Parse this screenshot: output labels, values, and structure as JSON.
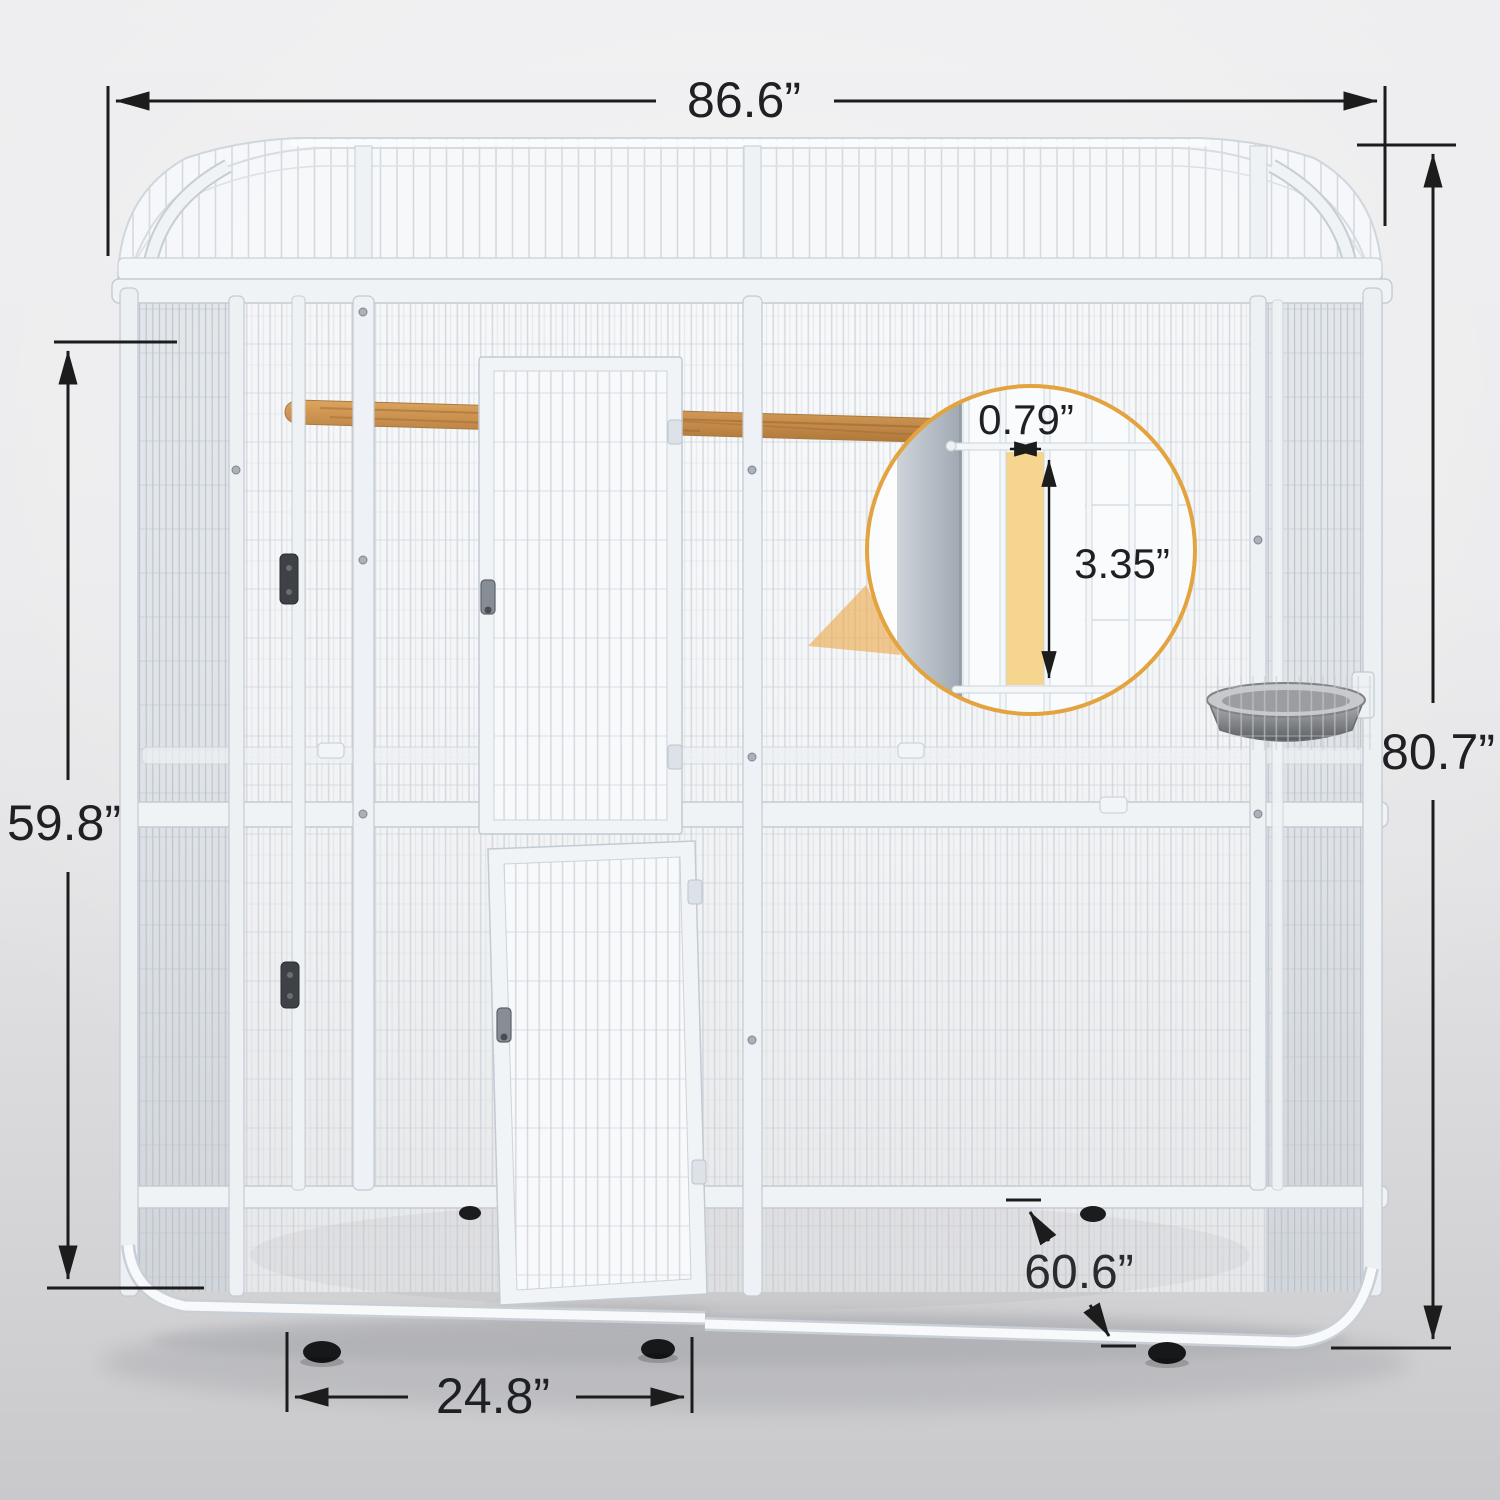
{
  "diagram": {
    "labels": {
      "overall_width": "86.6”",
      "overall_height": "80.7”",
      "side_panel_height": "59.8”",
      "door_width": "24.8”",
      "depth": "60.6”",
      "wire_gap_width": "0.79”",
      "wire_gap_height": "3.35”"
    },
    "colors": {
      "dimension_line": "#1C1C1C",
      "accent_orange": "#E3A33E",
      "highlight_yellow": "#F6D58F",
      "cage_frame_white": "#F2F5F7",
      "wood_perch": "#C89054",
      "background_gray": "#E6E6E8"
    }
  }
}
